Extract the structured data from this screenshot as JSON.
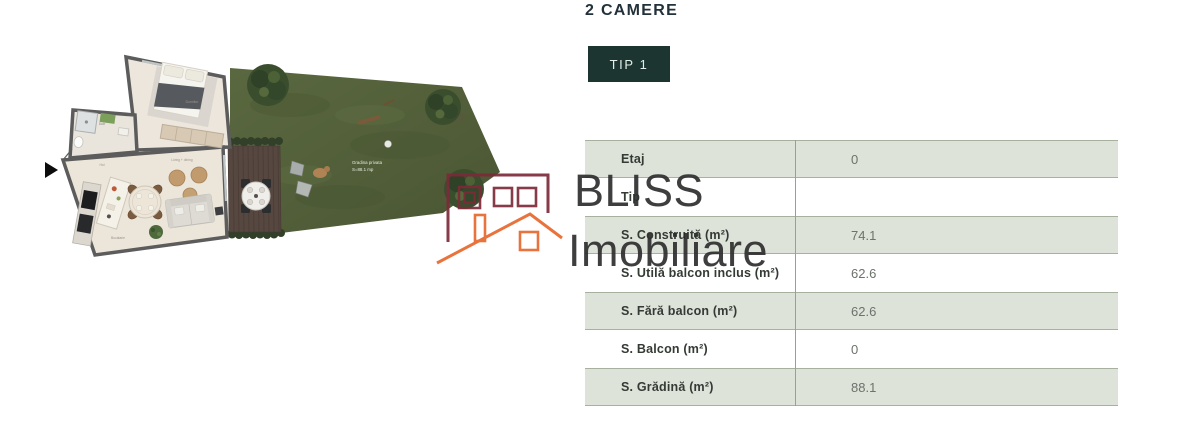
{
  "header": {
    "title": "2 CAMERE"
  },
  "type_tabs": {
    "items": [
      {
        "label": "TIP 1",
        "active": true
      }
    ]
  },
  "details_table": {
    "rows": [
      {
        "label": "Etaj",
        "value": "0"
      },
      {
        "label": "Tip",
        "value": ""
      },
      {
        "label": "S. Construită (m²)",
        "value": "74.1"
      },
      {
        "label": "S. Utilă balcon inclus (m²)",
        "value": "62.6"
      },
      {
        "label": "S. Fără balcon (m²)",
        "value": "62.6"
      },
      {
        "label": "S. Balcon (m²)",
        "value": "0"
      },
      {
        "label": "S. Grădină (m²)",
        "value": "88.1"
      }
    ]
  },
  "floor_plan": {
    "garden_label": {
      "line1": "Gradina privata",
      "line2": "S=88.1 mp"
    },
    "room_labels": {
      "bedroom": "Dormitor",
      "bathroom": "Baie",
      "hallway": "Hol",
      "living": "Living + dining",
      "kitchen": "Bucatarie"
    }
  },
  "watermark": {
    "brand_line1": "BLISS",
    "brand_line2": "Imobiliare"
  },
  "colors": {
    "accent_dark_teal": "#1c3531",
    "table_row_shaded": "#dde3d9",
    "heading_text": "#22313a",
    "logo_maroon": "#7d2a38",
    "logo_orange": "#e8682c",
    "garden_green": "#52603c"
  }
}
